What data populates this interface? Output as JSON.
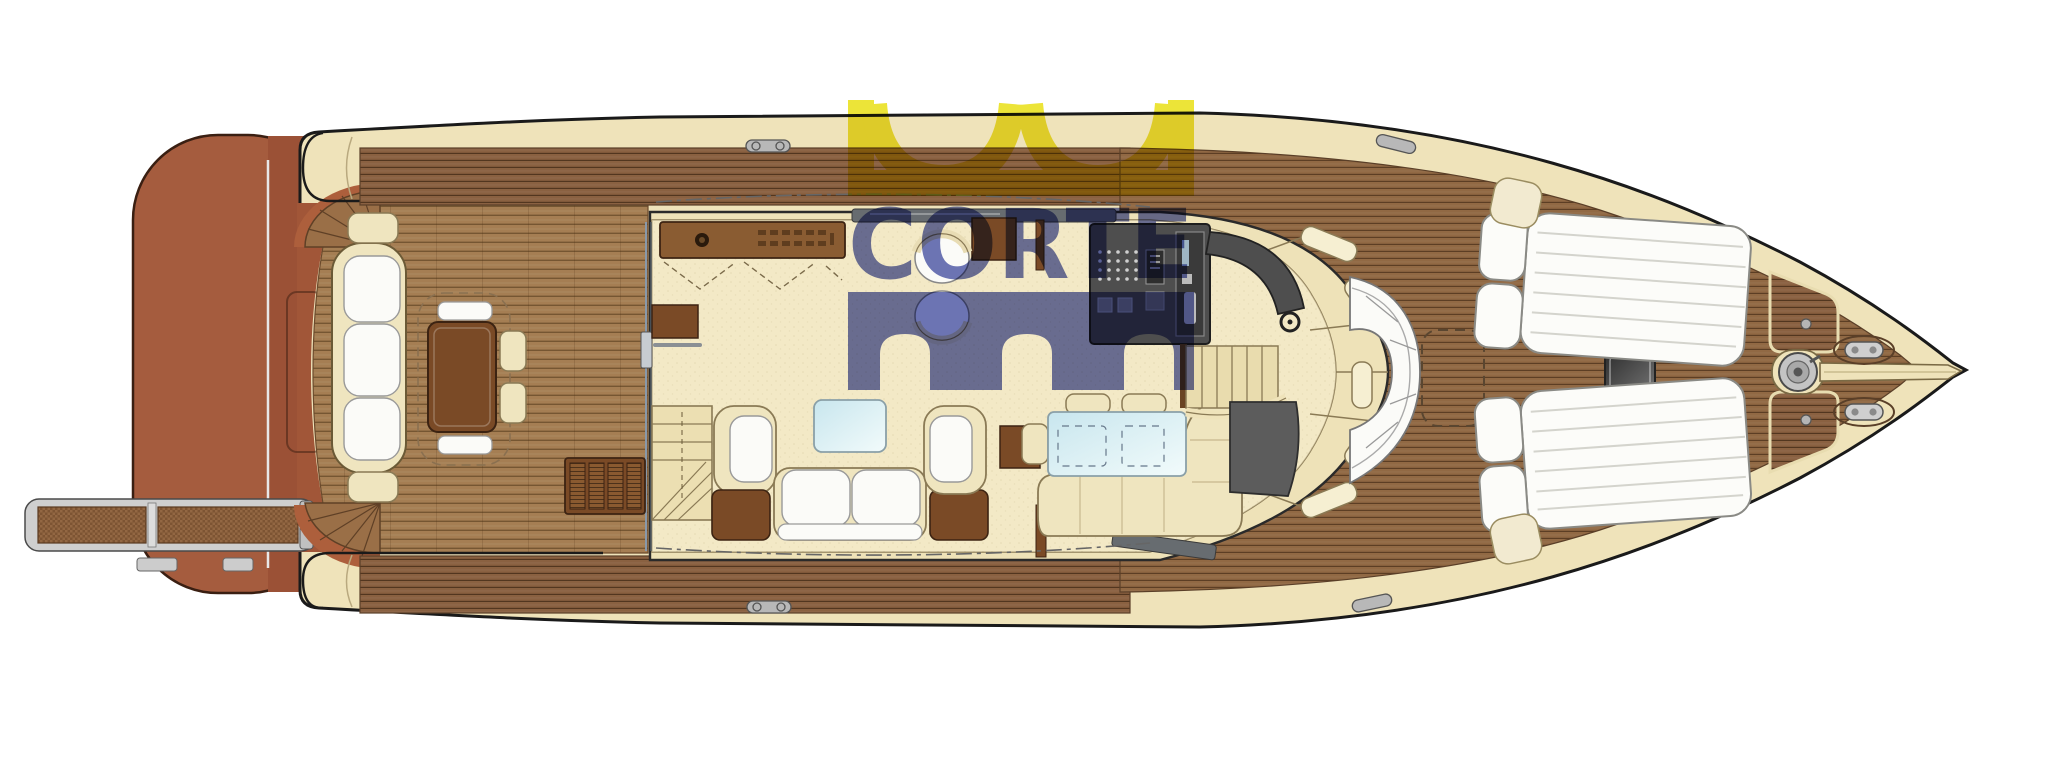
{
  "watermark": {
    "text": "CORTE",
    "text_color": "#4a54a6",
    "crown_color": "#e9e01a",
    "arch_color": "#4a54a6"
  },
  "colors": {
    "background": "#ffffff",
    "hull_cream": "#efe3ba",
    "gunwale_cream": "#f2e8c6",
    "teak_side_deck": "#8a6141",
    "teak_cockpit": "#a57e53",
    "teak_foredeck": "#916944",
    "swim_platform": "#a55c3e",
    "swim_platform_dark": "#9b5136",
    "interior_floor": "#f3e9c6",
    "upholstery_cream": "#efe5bf",
    "cushion_white": "#fbfbf8",
    "furniture_wood": "#7a4a26",
    "glass_table": "#cfe9ef",
    "console_dark": "#4e4e4e",
    "metal": "#c9c9c9",
    "outline": "#1a1a1a"
  },
  "regions": [
    "passerelle-gangway",
    "swim-platform",
    "transom-garage-hatch",
    "aft-deck-cockpit",
    "fan-stairs-port",
    "fan-stairs-starboard",
    "transom-sofa",
    "cockpit-table",
    "salon",
    "salon-sofa",
    "coffee-table",
    "nav-seating-nook",
    "dining-area",
    "galley",
    "helm-station",
    "companionway-stairs",
    "bow-settee",
    "sun-pad-port",
    "sun-pad-starboard",
    "foredeck",
    "windlass",
    "anchor-channel",
    "bow-cleats"
  ]
}
